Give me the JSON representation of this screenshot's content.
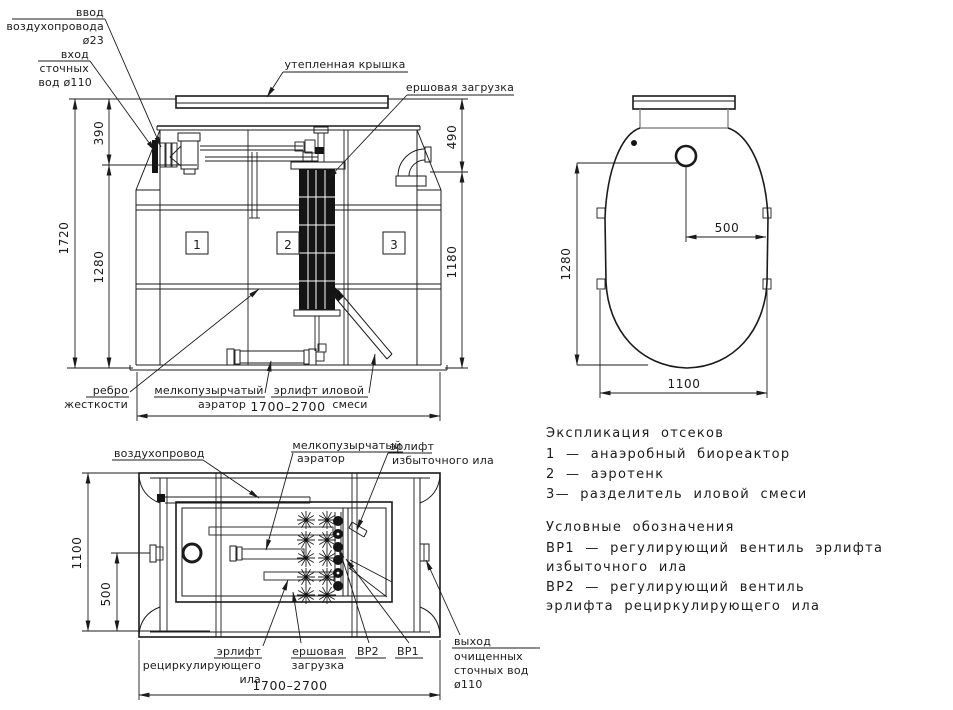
{
  "front_view": {
    "air_inlet_label": [
      "ввод",
      "воздухопровода",
      "ø23"
    ],
    "sewage_inlet_label": [
      "вход",
      "сточных",
      "вод ø110"
    ],
    "lid_label": "утепленная  крышка",
    "brush_label": "ершовая  загрузка",
    "rib_label": [
      "ребро",
      "жесткости"
    ],
    "aerator_label": [
      "мелкопузырчатый",
      "аэратор"
    ],
    "sludge_airlift_label": [
      "эрлифт  иловой",
      "смеси"
    ],
    "compartments": [
      "1",
      "2",
      "3"
    ],
    "dims": {
      "h_total": "1720",
      "h_inlet": "390",
      "h_body_left": "1280",
      "h_top_right": "490",
      "h_body_right": "1180",
      "width": "1700–2700"
    }
  },
  "top_view": {
    "dims": {
      "height": "1280",
      "offset": "500",
      "width": "1100"
    }
  },
  "plan_view": {
    "air_pipe_label": "воздухопровод",
    "aerator_label": [
      "мелкопузырчатый",
      "аэратор"
    ],
    "excess_airlift_label": [
      "эрлифт",
      "избыточного  ила"
    ],
    "recirc_airlift_label": [
      "эрлифт",
      "рециркулирующего",
      "ила"
    ],
    "brush_label": [
      "ершовая",
      "загрузка"
    ],
    "valve2_label": "ВР2",
    "valve1_label": "ВР1",
    "outlet_label": [
      "выход",
      "очищенных",
      "сточных  вод",
      "ø110"
    ],
    "dims": {
      "height": "1100",
      "offset": "500",
      "width": "1700–2700"
    }
  },
  "legend": {
    "compartments_title": "Экспликация  отсеков",
    "compartments": [
      "1  —   анаэробный  биореактор",
      "2  —   аэротенк",
      "3—   разделитель  иловой  смеси"
    ],
    "symbols_title": "Условные  обозначения",
    "symbols": [
      "ВР1  —   регулирующий  вентиль  эрлифта",
      "избыточного  ила",
      "ВР2  —   регулирующий  вентиль",
      "эрлифта  рециркулирующего  ила"
    ]
  }
}
